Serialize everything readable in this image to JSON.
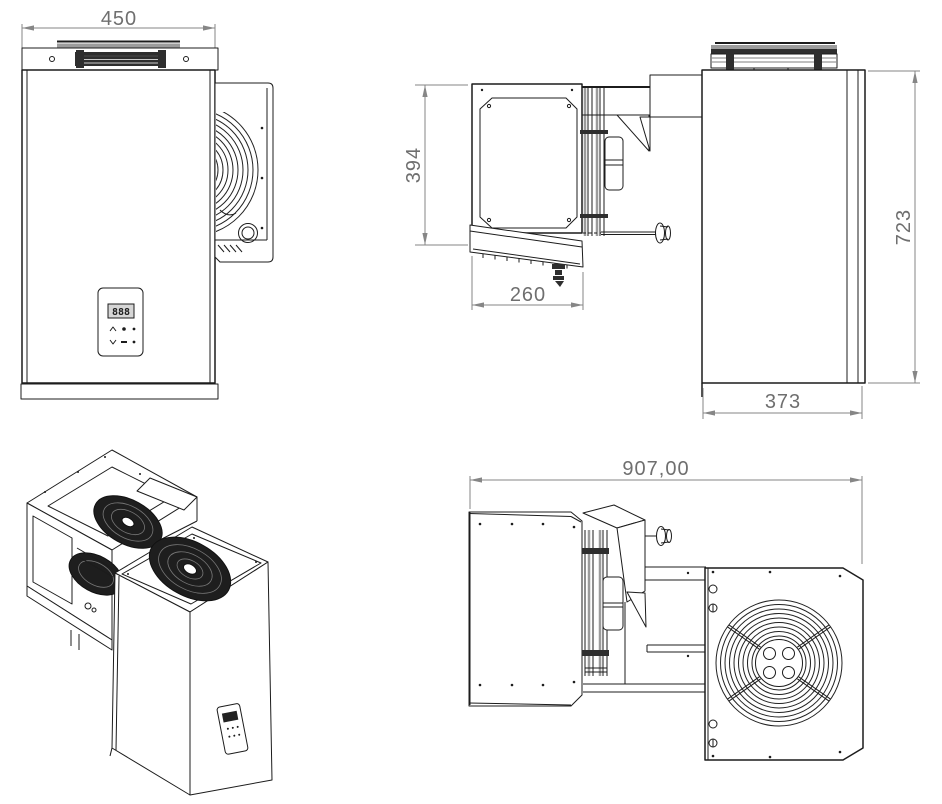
{
  "drawing": {
    "dimensions": {
      "front_width": "450",
      "evaporator_height": "394",
      "evaporator_depth": "260",
      "condenser_height": "723",
      "condenser_depth": "373",
      "overall_length": "907,00"
    },
    "control_panel": {
      "display": "888"
    },
    "colors": {
      "line": "#1c1c1c",
      "dimension_line": "#868686",
      "dimension_text": "#6f6f6f",
      "hatch_dark": "#2e2e2e",
      "hatch_gray": "#9c9c9c",
      "background": "#ffffff"
    }
  }
}
